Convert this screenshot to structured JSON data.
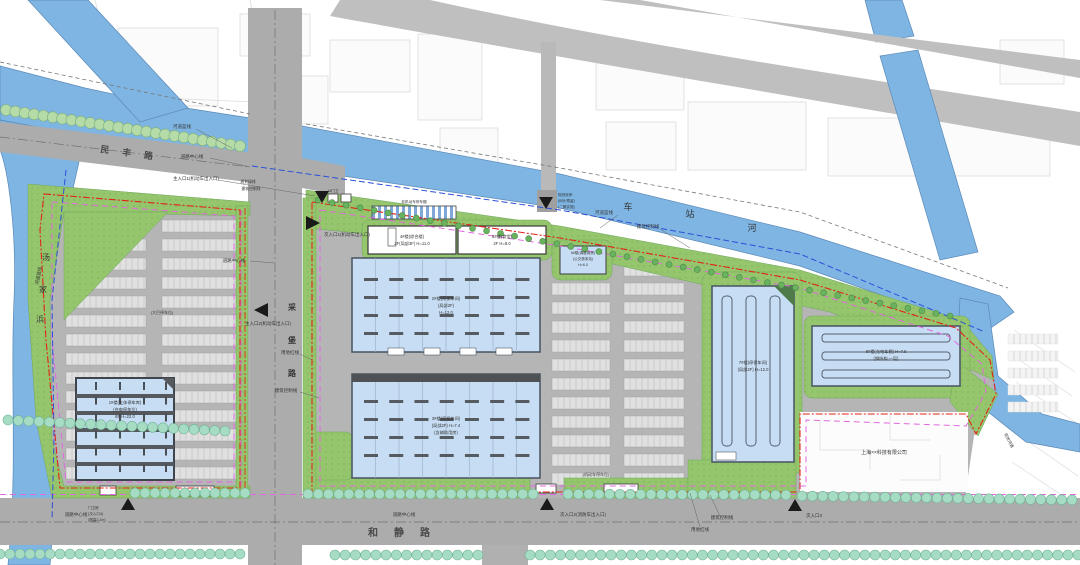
{
  "colors": {
    "river": "#7fb5e3",
    "green": "#95c56c",
    "road": "#acacac",
    "site": "#b5b5b5",
    "building_blue": "#c7ddf4",
    "red_line": "#e2231a",
    "control_line": "#e168e1",
    "blue_line": "#2b50d8",
    "tree_teal": "#a5dcc3",
    "tree_green": "#b5dca8"
  },
  "roads": {
    "minfeng": "民　丰　路",
    "hejing": "和　静　路",
    "vertical_chars": [
      "采",
      "堡",
      "路"
    ],
    "center_line1": "道路中心线",
    "center_line2": "道路中心线",
    "center_line3": "道路中心线",
    "center_line4": "道路中心线"
  },
  "rivers": {
    "tangjiabang_chars": [
      "汤",
      "家",
      "浜"
    ],
    "chezhan_chars": [
      "车",
      "站",
      "河"
    ],
    "blue_line1": "河道蓝线",
    "blue_line2": "河道蓝线",
    "blue_line3": "河道蓝线",
    "exist_river": "现状河道"
  },
  "boundary": {
    "red_line1": "用地红线",
    "red_line2": "用地红线",
    "control_line1": "建筑控制线",
    "control_line2": "建筑控制线",
    "control_line3": "建筑控制线",
    "green_line": "规划绿线",
    "green_line_sub": "建筑控制线"
  },
  "entrances": {
    "main1": "主入口1(机动车出入口)",
    "main2": "主入口2(机动车出入口)",
    "sub1": "次入口1(机动车出入口)",
    "sub2": "次入口2(消防车出入口)",
    "sub3": "次入口3",
    "gate": {
      "l1": "门卫房",
      "l2": "(次入口4)",
      "l3": "(限高2.2m)"
    },
    "dock": {
      "l1": "规划驳岸",
      "l2": "(码头预留)",
      "l3": "(二期实施)"
    }
  },
  "buildings": {
    "b1": {
      "l1": "1#楼(立体停车库)",
      "l2": "(充电停车位)",
      "l3": "6F  H=22.0"
    },
    "b2": {
      "l1": "2#楼(停保车间)",
      "l2": "(局部2F)",
      "l3": "H=12.0"
    },
    "b3": {
      "l1": "3#楼(停保车间)",
      "l2": "(局部2F)  H=7.4",
      "l3": "(含辅助用房)"
    },
    "b4": {
      "l1": "4#楼(综合楼)",
      "l2": "2F(局部3F) H=11.0"
    },
    "b5": {
      "l1": "5#楼(食堂)",
      "l2": "2F  H=8.0"
    },
    "b6": {
      "l1": "6#楼(调度用房)",
      "l2": "(公交首末站)",
      "l3": "H=6.0"
    },
    "b7": {
      "l1": "7#楼(停保车间)",
      "l2": "(局部2F)  H=12.0"
    },
    "b8": {
      "l1": "8#楼(充电车棚)  H=7.5",
      "l2": "(钢结构,一层)"
    },
    "bike_shed": "非机动车停车棚",
    "gate1": "1#门卫"
  },
  "misc": {
    "company": "上海××科技有限公司",
    "bus_parking": "(大巴停车位)",
    "car_parking": "(机动车停车位)"
  }
}
